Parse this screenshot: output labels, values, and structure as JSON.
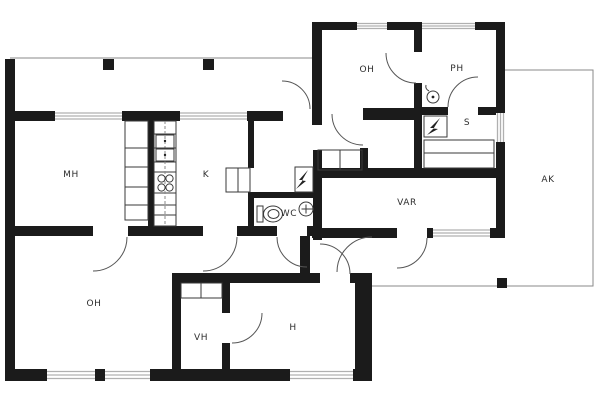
{
  "floorplan": {
    "background": "#ffffff",
    "wall_color": "#1b1b1b",
    "window_color": "#b0b0b0",
    "door_arc_color": "#555555",
    "rooms": [
      {
        "id": "mh",
        "label": "MH"
      },
      {
        "id": "k",
        "label": "K"
      },
      {
        "id": "oh_upper",
        "label": "OH"
      },
      {
        "id": "ph",
        "label": "PH"
      },
      {
        "id": "s",
        "label": "S"
      },
      {
        "id": "ak",
        "label": "AK"
      },
      {
        "id": "var",
        "label": "VAR"
      },
      {
        "id": "wc",
        "label": "WC"
      },
      {
        "id": "oh_lower",
        "label": "OH"
      },
      {
        "id": "vh",
        "label": "VH"
      },
      {
        "id": "h",
        "label": "H"
      }
    ],
    "icons": [
      "toilet-icon",
      "sink-icon",
      "shower-icon",
      "stove-icon",
      "fridge-icon",
      "sauna-heater-icon",
      "electrical-panel-icon",
      "wardrobe-icon",
      "sauna-bench-icon"
    ]
  }
}
